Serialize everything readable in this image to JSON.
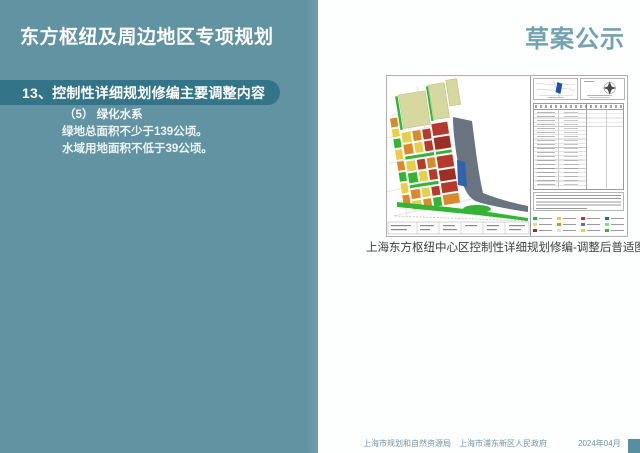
{
  "colors": {
    "panel_teal": "#6293a2",
    "section_bar_teal": "#337488",
    "draft_label_teal": "#74a2b0",
    "footer_text": "#7796a3",
    "corner_square": "#578ea0"
  },
  "header": {
    "title": "东方枢纽及周边地区专项规划",
    "draft_label": "草案公示"
  },
  "sidebar": {
    "section_title": "13、控制性详细规划修编主要调整内容",
    "item_heading": "（5） 绿化水系",
    "lines": [
      "绿地总面积不少于139公顷。",
      "水域用地面积不低于39公顷。"
    ]
  },
  "figure": {
    "caption": "上海东方枢纽中心区控制性详细规划修编-调整后普适图则",
    "map_palette": {
      "red_blocks": "#b6392c",
      "dark_red_blocks": "#9c2f24",
      "orange_blocks": "#d98a2b",
      "yellow_blocks": "#e7cf4a",
      "green_space": "#33b533",
      "khaki_blocks": "#d6d8a0",
      "hub_gray_band": "#6a7481",
      "water_blue": "#2f63ae"
    }
  },
  "footer": {
    "org1": "上海市规划和自然资源局",
    "org2": "上海市浦东新区人民政府",
    "date": "2024年04月"
  }
}
